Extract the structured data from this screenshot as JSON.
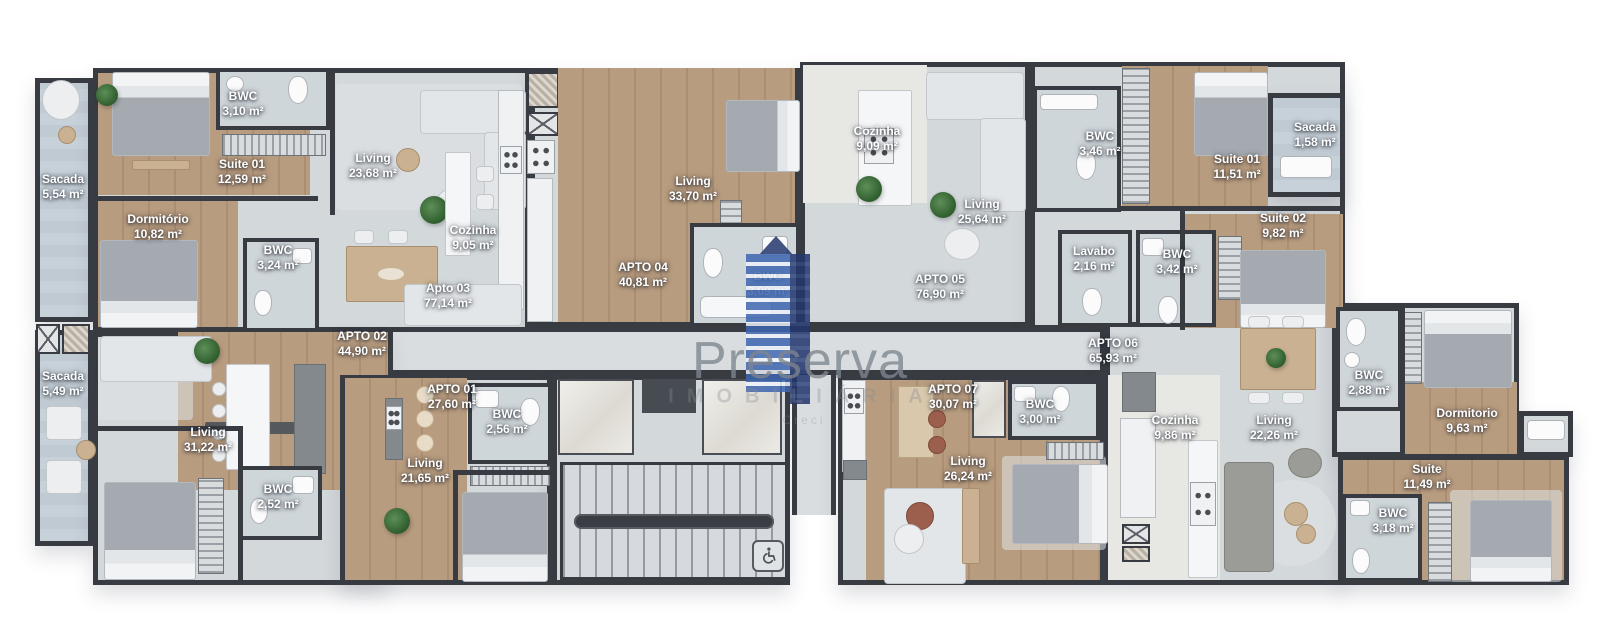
{
  "watermark": {
    "brand": "Preserva",
    "subtitle": "IMOBILIÁRIA",
    "tagline": "Creci",
    "logo_blue": "#3e66b0",
    "logo_navy": "#22366e"
  },
  "palette": {
    "wall": "#383c42",
    "tile_floor": "#d3d8db",
    "wood_floor": "#b89c7f",
    "balcony_floor": "#c4ced6",
    "background": "#ffffff"
  },
  "accessibility": {
    "icon": "wheelchair-symbol"
  },
  "rooms": [
    {
      "name": "Sacada",
      "area": "5,54 m²",
      "x": 63,
      "y": 187
    },
    {
      "name": "BWC",
      "area": "3,10 m²",
      "x": 243,
      "y": 104
    },
    {
      "name": "Suite 01",
      "area": "12,59 m²",
      "x": 242,
      "y": 172
    },
    {
      "name": "Living",
      "area": "23,68 m²",
      "x": 373,
      "y": 166
    },
    {
      "name": "Dormitório",
      "area": "10,82 m²",
      "x": 158,
      "y": 227
    },
    {
      "name": "BWC",
      "area": "3,24 m²",
      "x": 278,
      "y": 258
    },
    {
      "name": "Cozinha",
      "area": "9,05 m²",
      "x": 473,
      "y": 238
    },
    {
      "name": "Apto 03",
      "area": "77,14 m²",
      "x": 448,
      "y": 296
    },
    {
      "name": "Living",
      "area": "33,70 m²",
      "x": 693,
      "y": 189
    },
    {
      "name": "APTO 04",
      "area": "40,81 m²",
      "x": 643,
      "y": 275
    },
    {
      "name": "Cozinha",
      "area": "9,09 m²",
      "x": 877,
      "y": 139
    },
    {
      "name": "BWC",
      "area": "3,09 m²",
      "x": 768,
      "y": 284
    },
    {
      "name": "Living",
      "area": "25,64 m²",
      "x": 982,
      "y": 212
    },
    {
      "name": "APTO 05",
      "area": "76,90 m²",
      "x": 940,
      "y": 287
    },
    {
      "name": "BWC",
      "area": "3,46 m²",
      "x": 1100,
      "y": 144
    },
    {
      "name": "Suite 01",
      "area": "11,51 m²",
      "x": 1237,
      "y": 167
    },
    {
      "name": "Sacada",
      "area": "1,58 m²",
      "x": 1315,
      "y": 135
    },
    {
      "name": "Suite 02",
      "area": "9,82 m²",
      "x": 1283,
      "y": 226
    },
    {
      "name": "Lavabo",
      "area": "2,16 m²",
      "x": 1094,
      "y": 259
    },
    {
      "name": "BWC",
      "area": "3,42 m²",
      "x": 1177,
      "y": 262
    },
    {
      "name": "Sacada",
      "area": "5,49 m²",
      "x": 63,
      "y": 384
    },
    {
      "name": "APTO 02",
      "area": "44,90 m²",
      "x": 362,
      "y": 344
    },
    {
      "name": "Living",
      "area": "31,22 m²",
      "x": 208,
      "y": 440
    },
    {
      "name": "BWC",
      "area": "2,52 m²",
      "x": 278,
      "y": 497
    },
    {
      "name": "APTO 01",
      "area": "27,60 m²",
      "x": 452,
      "y": 397
    },
    {
      "name": "BWC",
      "area": "2,56 m²",
      "x": 507,
      "y": 422
    },
    {
      "name": "Living",
      "area": "21,65 m²",
      "x": 425,
      "y": 471
    },
    {
      "name": "APTO 06",
      "area": "65,93 m²",
      "x": 1113,
      "y": 351
    },
    {
      "name": "APTO 07",
      "area": "30,07 m²",
      "x": 953,
      "y": 397
    },
    {
      "name": "BWC",
      "area": "3,00 m²",
      "x": 1040,
      "y": 412
    },
    {
      "name": "Living",
      "area": "26,24 m²",
      "x": 968,
      "y": 469
    },
    {
      "name": "Cozinha",
      "area": "9,86 m²",
      "x": 1175,
      "y": 428
    },
    {
      "name": "Living",
      "area": "22,26 m²",
      "x": 1274,
      "y": 428
    },
    {
      "name": "BWC",
      "area": "2,88 m²",
      "x": 1369,
      "y": 383
    },
    {
      "name": "Dormitorio",
      "area": "9,63 m²",
      "x": 1467,
      "y": 421
    },
    {
      "name": "Suite",
      "area": "11,49 m²",
      "x": 1427,
      "y": 477
    },
    {
      "name": "BWC",
      "area": "3,18 m²",
      "x": 1393,
      "y": 521
    }
  ]
}
